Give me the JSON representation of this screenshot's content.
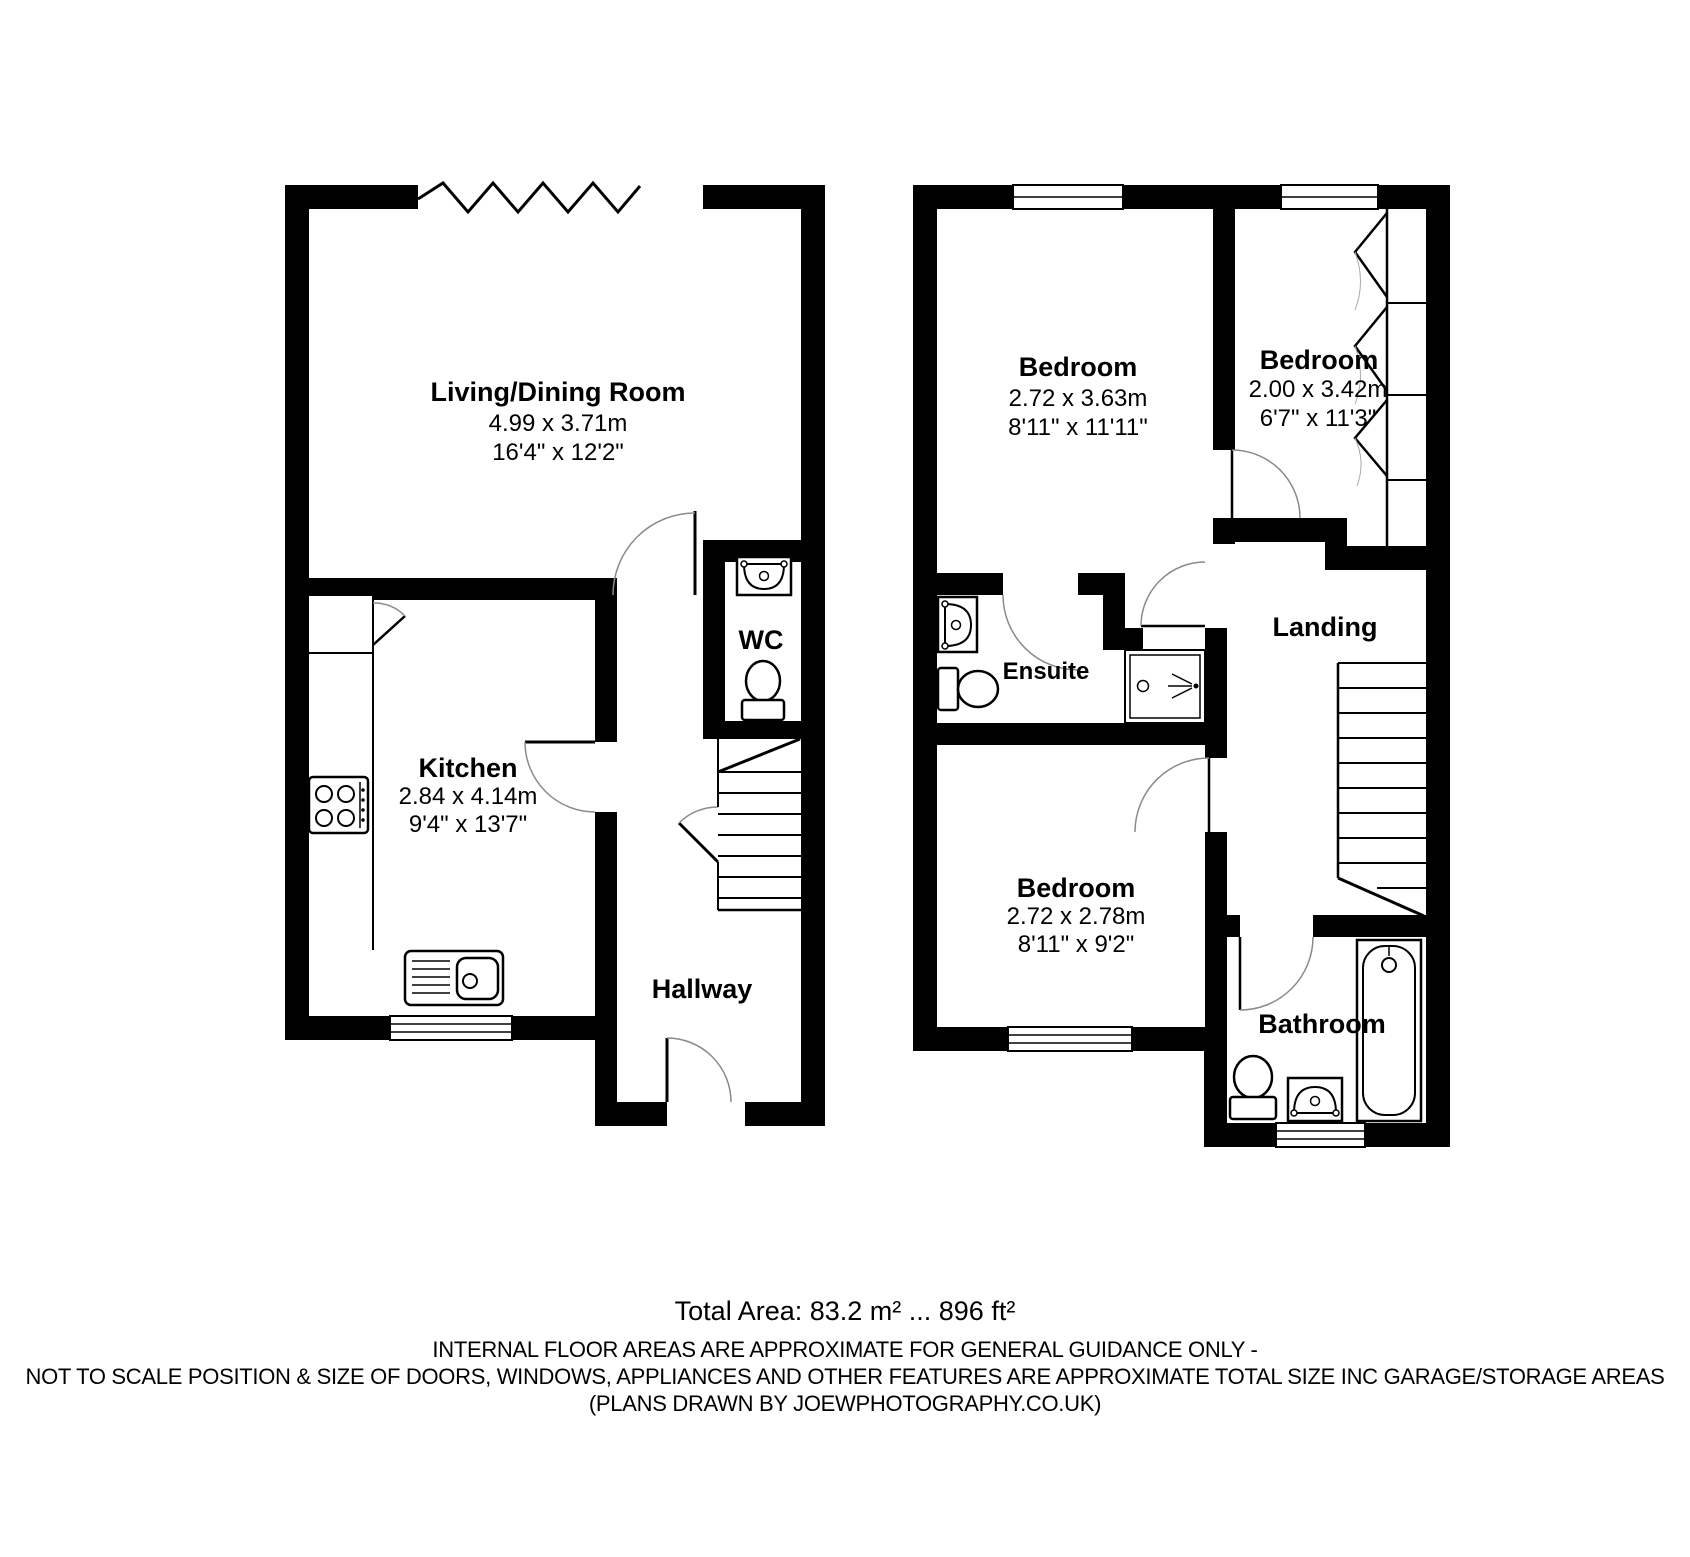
{
  "plan": {
    "ground_floor": {
      "living": {
        "name": "Living/Dining Room",
        "metric": "4.99 x 3.71m",
        "imperial": "16'4\" x 12'2\""
      },
      "kitchen": {
        "name": "Kitchen",
        "metric": "2.84 x 4.14m",
        "imperial": "9'4\" x 13'7\""
      },
      "wc": {
        "name": "WC"
      },
      "hallway": {
        "name": "Hallway"
      }
    },
    "first_floor": {
      "bedroom1": {
        "name": "Bedroom",
        "metric": "2.72 x 3.63m",
        "imperial": "8'11\" x 11'11\""
      },
      "bedroom2": {
        "name": "Bedroom",
        "metric": "2.00 x 3.42m",
        "imperial": "6'7\" x 11'3\""
      },
      "bedroom3": {
        "name": "Bedroom",
        "metric": "2.72 x 2.78m",
        "imperial": "8'11\" x 9'2\""
      },
      "ensuite": {
        "name": "Ensuite"
      },
      "landing": {
        "name": "Landing"
      },
      "bathroom": {
        "name": "Bathroom"
      }
    }
  },
  "footer": {
    "total_area": "Total Area: 83.2 m² ... 896 ft²",
    "disclaimer_line1": "INTERNAL FLOOR AREAS ARE APPROXIMATE FOR GENERAL GUIDANCE ONLY -",
    "disclaimer_line2": "NOT TO SCALE POSITION & SIZE OF DOORS, WINDOWS, APPLIANCES AND OTHER FEATURES ARE APPROXIMATE TOTAL SIZE INC GARAGE/STORAGE AREAS",
    "credit": "(PLANS DRAWN BY JOEWPHOTOGRAPHY.CO.UK)"
  },
  "colors": {
    "walls": "#000000",
    "background": "#ffffff",
    "door_arc": "#8a8a8a"
  }
}
